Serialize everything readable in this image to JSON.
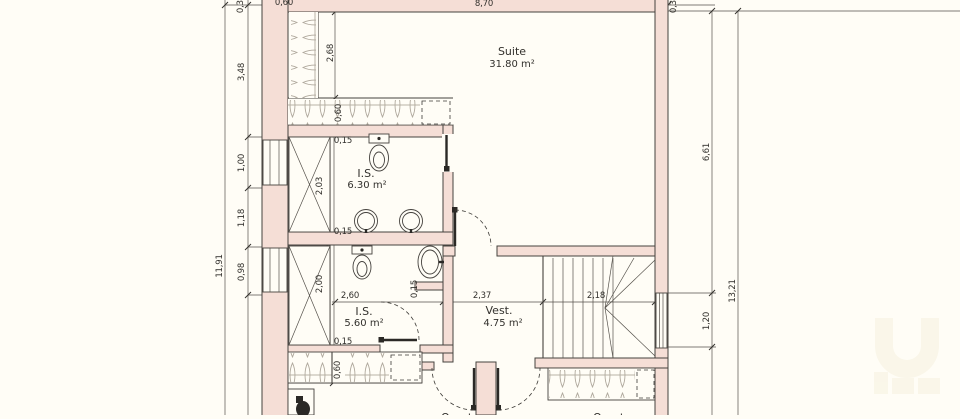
{
  "canvas": {
    "width": 960,
    "height": 415,
    "background": "#fffdf6"
  },
  "colors": {
    "wall_fill": "#f5ded6",
    "wall_stroke": "#45423e",
    "thin_line": "#55514b",
    "hatch": "#b0a99d",
    "text": "#32302c",
    "watermark": "#f8f3e3"
  },
  "rooms": {
    "suite": {
      "name": "Suite",
      "area": "31.80 m²"
    },
    "is_top": {
      "name": "I.S.",
      "area": "6.30 m²"
    },
    "is_bottom": {
      "name": "I.S.",
      "area": "5.60 m²"
    },
    "vest": {
      "name": "Vest.",
      "area": "4.75 m²"
    },
    "room_below_left": {
      "name": "Quarto"
    },
    "room_below_right": {
      "name": "Quarto"
    }
  },
  "dimensions": {
    "left_total": "11,91",
    "left_top": "3,48",
    "left_window1": "1,00",
    "left_pier": "1,18",
    "left_window2": "0,98",
    "right_total": "13,21",
    "right_upper": "6,61",
    "right_landing": "1,20",
    "top_wall": "0,30",
    "top_closet": "0,60",
    "top_suite": "8,70",
    "top_right_wall": "0,30",
    "closet_height": "2,68",
    "closet_depth": "0,60",
    "is_top_wall_a": "0,15",
    "is_top_height": "2,03",
    "is_top_wall_b": "0,15",
    "is_bottom_height": "2,00",
    "is_bottom_width": "2,60",
    "is_bottom_wall": "0,15",
    "is_bottom_niche": "0,15",
    "vest_width": "2,37",
    "stairs_width": "2,18",
    "bottom_closet_depth": "0,60"
  }
}
